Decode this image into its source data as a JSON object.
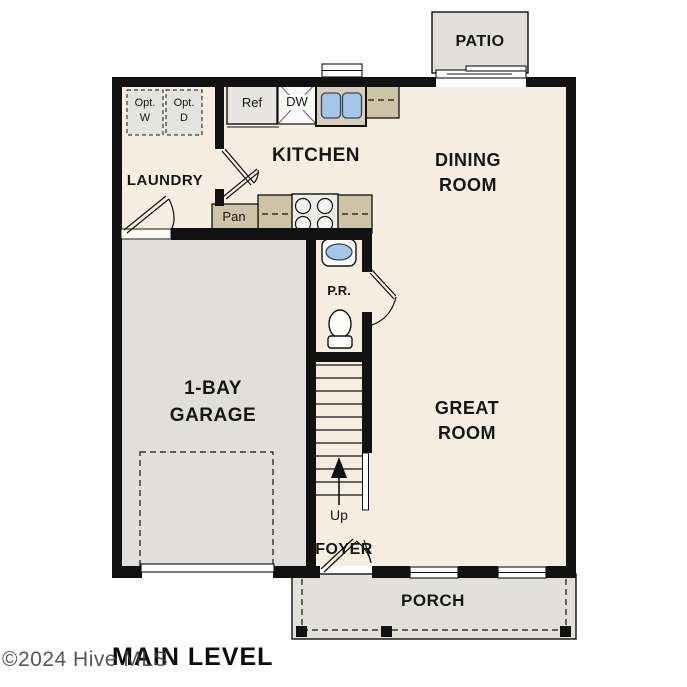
{
  "plan": {
    "level_label": "MAIN LEVEL",
    "watermark": "©2024 Hive MLS",
    "rooms": {
      "kitchen": "KITCHEN",
      "dining_line1": "DINING",
      "dining_line2": "ROOM",
      "great_line1": "GREAT",
      "great_line2": "ROOM",
      "laundry": "LAUNDRY",
      "garage_line1": "1-BAY",
      "garage_line2": "GARAGE",
      "patio": "PATIO",
      "porch": "PORCH",
      "foyer": "FOYER",
      "powder_room": "P.R."
    },
    "fixtures": {
      "refrigerator": "Ref",
      "dishwasher": "DW",
      "pantry": "Pan",
      "opt_washer_line1": "Opt.",
      "opt_washer_line2": "W",
      "opt_dryer_line1": "Opt.",
      "opt_dryer_line2": "D",
      "stairs_direction": "Up"
    },
    "colors": {
      "floor": "#f6eee1",
      "garage_floor": "#e0dfdc",
      "outdoor": "#e1e0db",
      "counter": "#cec2a7",
      "fixture_blue": "#a5c7e7",
      "wall": "#111111"
    }
  }
}
